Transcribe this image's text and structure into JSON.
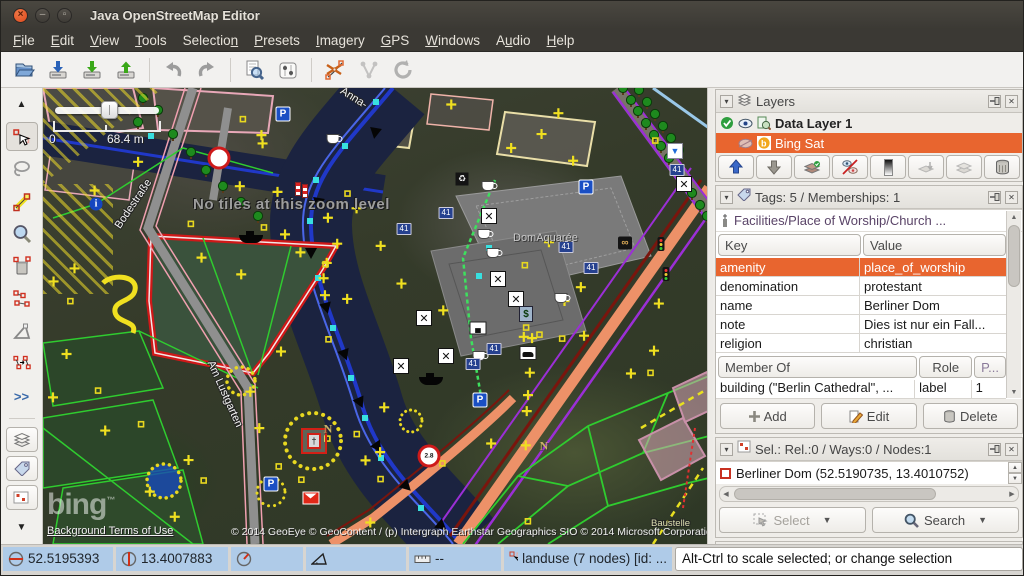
{
  "window": {
    "title": "Java OpenStreetMap Editor"
  },
  "menu": {
    "items": [
      {
        "label": "File",
        "mnemonic_index": 0
      },
      {
        "label": "Edit",
        "mnemonic_index": 0
      },
      {
        "label": "View",
        "mnemonic_index": 0
      },
      {
        "label": "Tools",
        "mnemonic_index": 0
      },
      {
        "label": "Selection",
        "mnemonic_index": 8
      },
      {
        "label": "Presets",
        "mnemonic_index": 0
      },
      {
        "label": "Imagery",
        "mnemonic_index": 0
      },
      {
        "label": "GPS",
        "mnemonic_index": 0
      },
      {
        "label": "Windows",
        "mnemonic_index": 0
      },
      {
        "label": "Audio",
        "mnemonic_index": 1
      },
      {
        "label": "Help",
        "mnemonic_index": 0
      }
    ]
  },
  "toolbar": {
    "buttons": [
      "open",
      "save",
      "download",
      "upload",
      "|",
      "undo",
      "redo",
      "|",
      "search-objects",
      "preferences",
      "|",
      "split-way",
      "combine-way",
      "refresh"
    ]
  },
  "left_toolbar": {
    "tools": [
      "scroll-up",
      "move",
      "lasso",
      "draw",
      "zoom",
      "delete",
      "unglue",
      "extrude",
      "parallel",
      "more",
      "sep",
      "layers-panel",
      "tags-panel",
      "selection-panel",
      "scroll-down"
    ],
    "more_label": ">>"
  },
  "map": {
    "zoom_scale": {
      "min_label": "0",
      "max_label": "68.4 m"
    },
    "overlay_message": "No tiles at this zoom level",
    "labels": {
      "street1": "Bodestraße",
      "street2": "Am Lustgarten",
      "street3": "Anna-",
      "area1": "DomAquarée",
      "area2": "Baustelle"
    },
    "attribution": {
      "logo": "bing",
      "tm": "™",
      "terms": "Background Terms of Use",
      "copyright": "© 2014 GeoEye © GeoContent / (p) Intergraph Earthstar Geographics SIO © 2014 Microsoft Corporation"
    },
    "icons": [
      {
        "t": "parking",
        "x": 240,
        "y": 26,
        "label": "P"
      },
      {
        "t": "parking",
        "x": 543,
        "y": 99,
        "label": "P"
      },
      {
        "t": "parking",
        "x": 437,
        "y": 312,
        "label": "P"
      },
      {
        "t": "parking",
        "x": 228,
        "y": 396,
        "label": "P"
      },
      {
        "t": "rest",
        "x": 446,
        "y": 128,
        "label": "✕"
      },
      {
        "t": "rest",
        "x": 455,
        "y": 191,
        "label": "✕"
      },
      {
        "t": "rest",
        "x": 473,
        "y": 211,
        "label": "✕"
      },
      {
        "t": "rest",
        "x": 381,
        "y": 230,
        "label": "✕"
      },
      {
        "t": "rest",
        "x": 403,
        "y": 268,
        "label": "✕"
      },
      {
        "t": "rest",
        "x": 358,
        "y": 278,
        "label": "✕"
      },
      {
        "t": "rest",
        "x": 641,
        "y": 96,
        "label": "✕"
      },
      {
        "t": "coffee",
        "x": 290,
        "y": 51
      },
      {
        "t": "coffee",
        "x": 445,
        "y": 98
      },
      {
        "t": "coffee",
        "x": 441,
        "y": 146
      },
      {
        "t": "coffee",
        "x": 450,
        "y": 165
      },
      {
        "t": "coffee",
        "x": 518,
        "y": 210
      },
      {
        "t": "coffee",
        "x": 436,
        "y": 268
      },
      {
        "t": "b41",
        "x": 403,
        "y": 125,
        "label": "41"
      },
      {
        "t": "b41",
        "x": 523,
        "y": 159,
        "label": "41"
      },
      {
        "t": "b41",
        "x": 548,
        "y": 180,
        "label": "41"
      },
      {
        "t": "b41",
        "x": 451,
        "y": 261,
        "label": "41"
      },
      {
        "t": "b41",
        "x": 430,
        "y": 276,
        "label": "41"
      },
      {
        "t": "b41",
        "x": 361,
        "y": 141,
        "label": "41"
      },
      {
        "t": "b41",
        "x": 634,
        "y": 82,
        "label": "41"
      },
      {
        "t": "info",
        "x": 53,
        "y": 116,
        "label": "i"
      },
      {
        "t": "sign",
        "x": 176,
        "y": 70,
        "label": ""
      },
      {
        "t": "sign",
        "x": 386,
        "y": 368,
        "label": "2.8"
      },
      {
        "t": "tlight",
        "x": 618,
        "y": 156
      },
      {
        "t": "tlight",
        "x": 623,
        "y": 186
      },
      {
        "t": "pretzel",
        "x": 582,
        "y": 155,
        "label": "∞"
      },
      {
        "t": "bed",
        "x": 435,
        "y": 240,
        "label": "▄"
      },
      {
        "t": "car",
        "x": 485,
        "y": 265
      },
      {
        "t": "atm",
        "x": 483,
        "y": 226,
        "label": "$"
      },
      {
        "t": "funnel",
        "x": 632,
        "y": 63,
        "label": "▼"
      },
      {
        "t": "boat",
        "x": 208,
        "y": 151
      },
      {
        "t": "boat",
        "x": 388,
        "y": 293
      },
      {
        "t": "mail",
        "x": 268,
        "y": 410
      },
      {
        "t": "recycle",
        "x": 419,
        "y": 91,
        "label": "♻"
      },
      {
        "t": "monu",
        "x": 271,
        "y": 353,
        "label": "†"
      },
      {
        "t": "nlabel",
        "x": 285,
        "y": 341,
        "label": "N"
      },
      {
        "t": "nlabel",
        "x": 501,
        "y": 358,
        "label": "N"
      },
      {
        "t": "pole",
        "x": 255,
        "y": 101
      },
      {
        "t": "pole",
        "x": 262,
        "y": 103
      }
    ]
  },
  "panels": {
    "layers": {
      "title": "Layers",
      "rows": [
        {
          "name": "Data Layer 1"
        },
        {
          "name": "Bing Sat"
        }
      ]
    },
    "tags": {
      "title": "Tags: 5 / Memberships: 1",
      "preset": "Facilities/Place of Worship/Church ...",
      "columns": [
        "Key",
        "Value"
      ],
      "rows": [
        [
          "amenity",
          "place_of_worship"
        ],
        [
          "denomination",
          "protestant"
        ],
        [
          "name",
          "Berliner Dom"
        ],
        [
          "note",
          "Dies ist nur ein Fall..."
        ],
        [
          "religion",
          "christian"
        ]
      ],
      "membership_columns": [
        "Member Of",
        "Role",
        "P..."
      ],
      "membership_rows": [
        [
          "building (\"Berlin Cathedral\", ...",
          "label",
          "1"
        ]
      ],
      "buttons": {
        "add": "Add",
        "edit": "Edit",
        "delete": "Delete"
      }
    },
    "selection": {
      "title": "Sel.: Rel.:0 / Ways:0 / Nodes:1",
      "items": [
        "Berliner Dom (52.5190735, 13.4010752)"
      ],
      "select_label": "Select",
      "search_label": "Search"
    },
    "relations": {
      "title": "Relations: 186"
    }
  },
  "statusbar": {
    "lat": "52.5195393",
    "lon": "13.4007883",
    "heading": "",
    "angle": "",
    "distance": "--",
    "object_info": "landuse (7 nodes) [id: ...",
    "help_text": "Alt-Ctrl to scale selected; or change selection"
  }
}
